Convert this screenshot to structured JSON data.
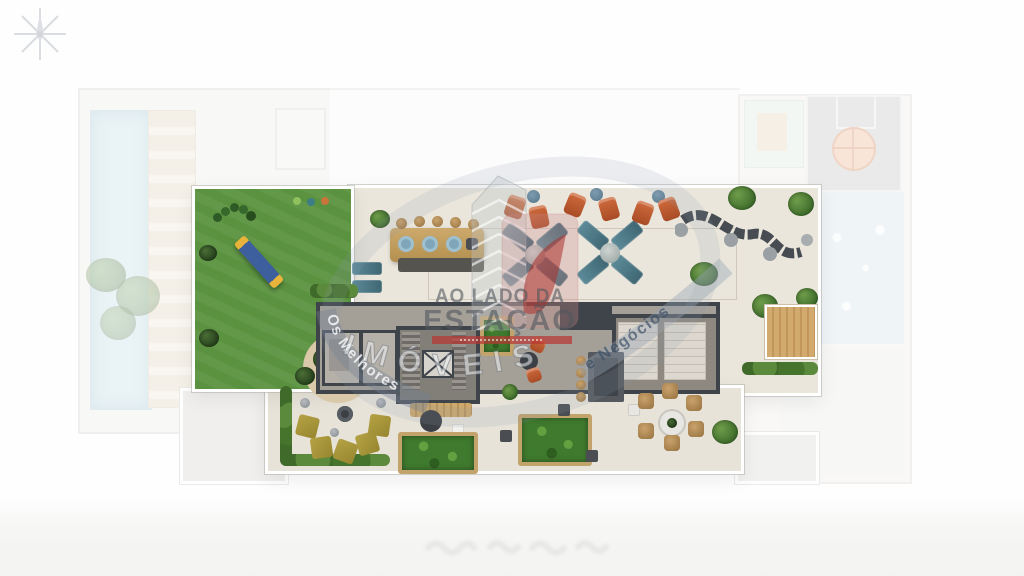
{
  "watermark": {
    "tagline_line1": "AO LADO DA",
    "tagline_line2": "ESTAÇÃO",
    "brand_word": "IMÓVEIS",
    "ribbon_left_text": "Os Melhores",
    "ribbon_right_text": "e Negócios"
  },
  "palette": {
    "lawn_green": "#5a9140",
    "terrace_cream": "#eae6dc",
    "wall_dark": "#3f444a",
    "pool_blue": "#d9e9ee",
    "accent_red": "#b83632",
    "chair_orange": "#bf5a30",
    "lounge_teal": "#54808e",
    "wood_tan": "#c2a36c",
    "ribbon_blue_grey": "#7e93a8"
  },
  "icons": {
    "compass_star": "compass-star-icon"
  }
}
